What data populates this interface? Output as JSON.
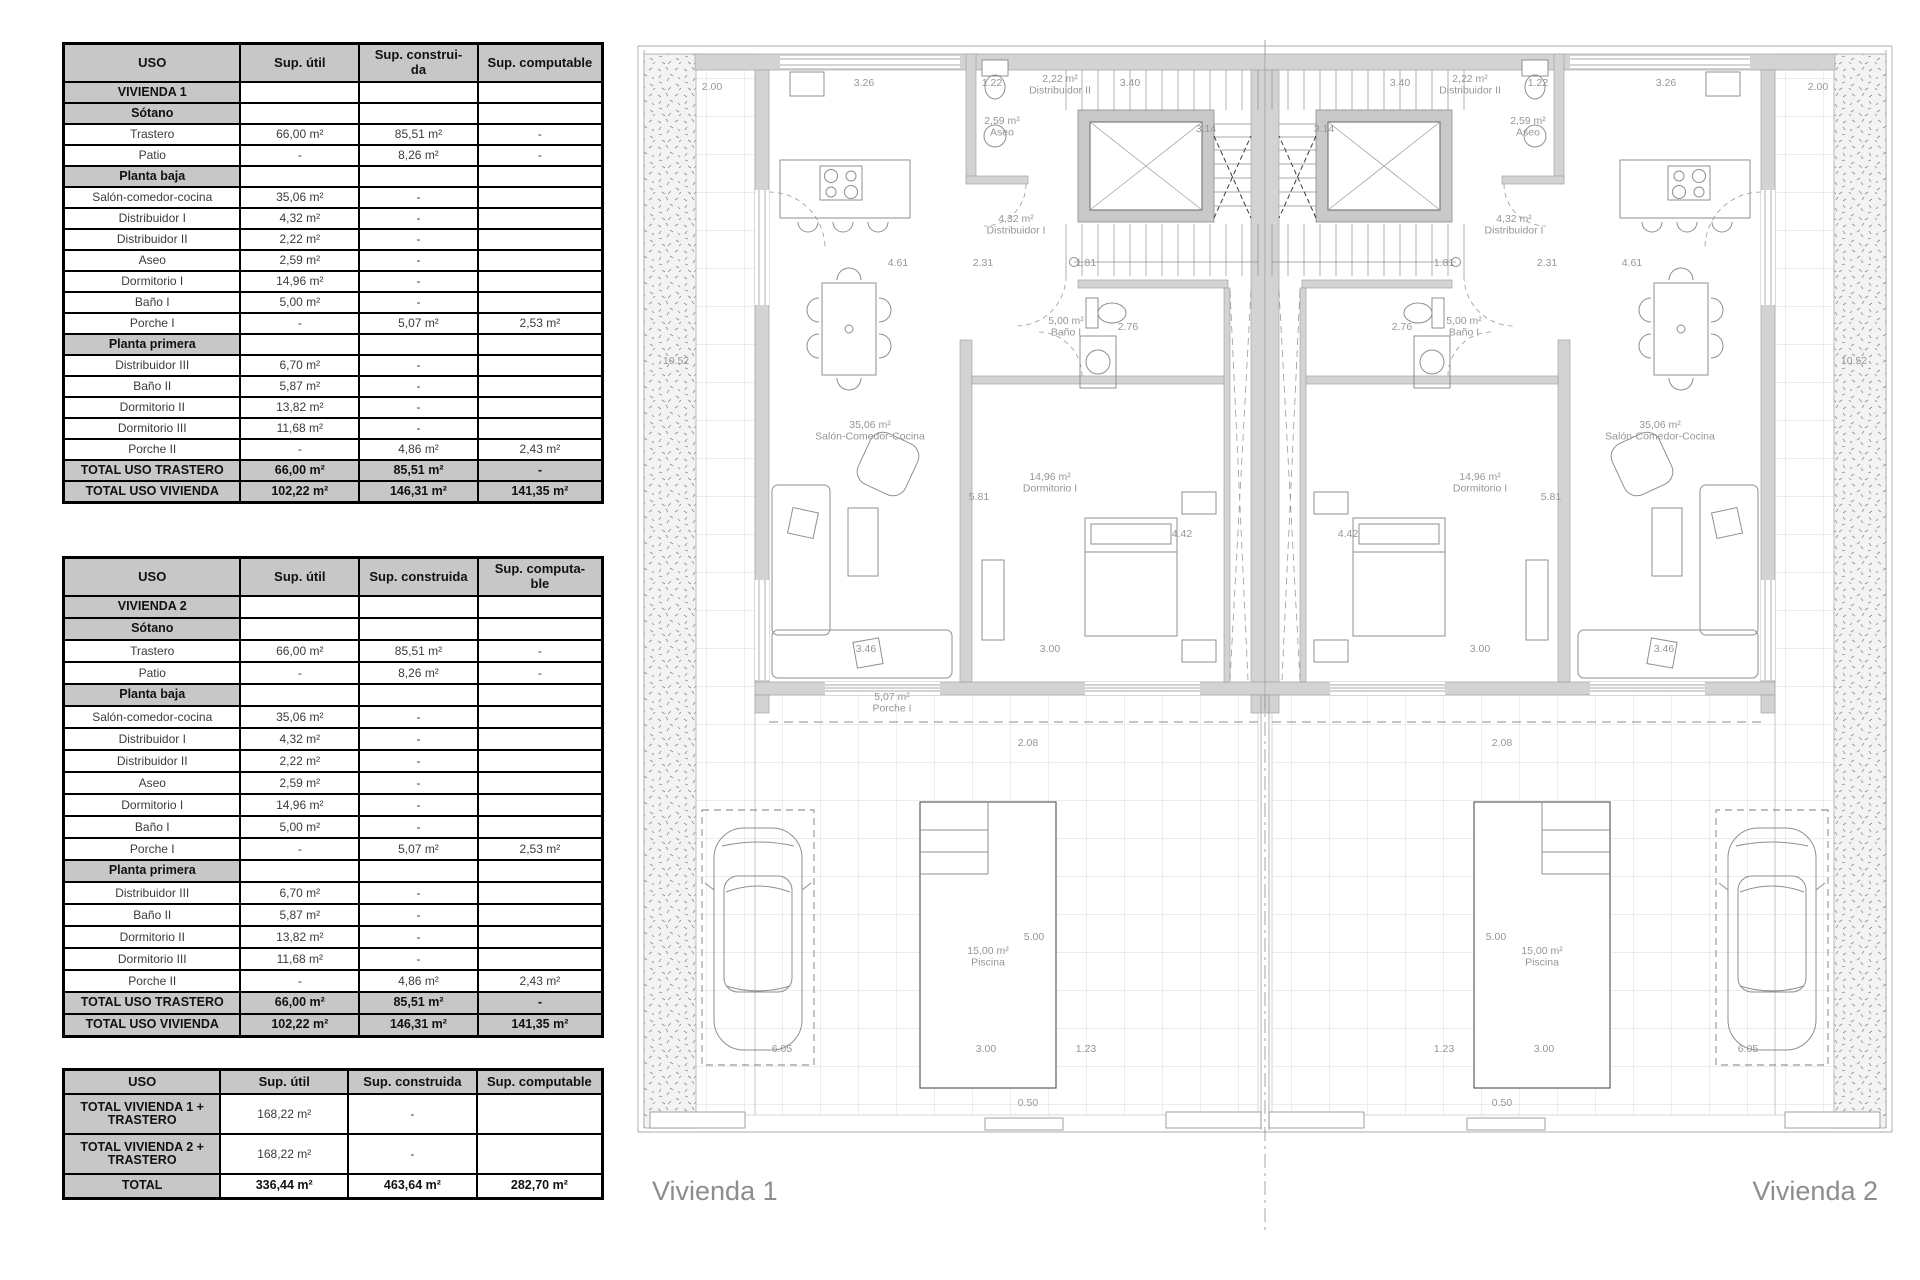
{
  "colors": {
    "table_header_bg": "#c7c7c7",
    "table_border": "#000000",
    "wall_fill": "#d3d3d3",
    "plan_label_gray": "#96969a",
    "unit_label_gray": "#8d8d8d"
  },
  "tables": [
    {
      "name": "vivienda-1-surfaces",
      "columns": [
        "USO",
        "Sup. útil",
        "Sup. construi-\nda",
        "Sup. computable"
      ],
      "rows": [
        {
          "type": "section",
          "cells": [
            "VIVIENDA 1",
            "",
            "",
            ""
          ]
        },
        {
          "type": "section",
          "cells": [
            "Sótano",
            "",
            "",
            ""
          ]
        },
        {
          "type": "data",
          "cells": [
            "Trastero",
            "66,00 m²",
            "85,51 m²",
            "-"
          ]
        },
        {
          "type": "data",
          "cells": [
            "Patio",
            "-",
            "8,26 m²",
            "-"
          ]
        },
        {
          "type": "section",
          "cells": [
            "Planta baja",
            "",
            "",
            ""
          ]
        },
        {
          "type": "data",
          "cells": [
            "Salón-comedor-cocina",
            "35,06 m²",
            "-",
            ""
          ]
        },
        {
          "type": "data",
          "cells": [
            "Distribuidor I",
            "4,32 m²",
            "-",
            ""
          ]
        },
        {
          "type": "data",
          "cells": [
            "Distribuidor II",
            "2,22 m²",
            "-",
            ""
          ]
        },
        {
          "type": "data",
          "cells": [
            "Aseo",
            "2,59 m²",
            "-",
            ""
          ]
        },
        {
          "type": "data",
          "cells": [
            "Dormitorio I",
            "14,96 m²",
            "-",
            ""
          ]
        },
        {
          "type": "data",
          "cells": [
            "Baño I",
            "5,00 m²",
            "-",
            ""
          ]
        },
        {
          "type": "data",
          "cells": [
            "Porche I",
            "-",
            "5,07 m²",
            "2,53 m²"
          ]
        },
        {
          "type": "section",
          "cells": [
            "Planta primera",
            "",
            "",
            ""
          ]
        },
        {
          "type": "data",
          "cells": [
            "Distribuidor III",
            "6,70 m²",
            "-",
            ""
          ]
        },
        {
          "type": "data",
          "cells": [
            "Baño II",
            "5,87 m²",
            "-",
            ""
          ]
        },
        {
          "type": "data",
          "cells": [
            "Dormitorio II",
            "13,82 m²",
            "-",
            ""
          ]
        },
        {
          "type": "data",
          "cells": [
            "Dormitorio III",
            "11,68 m²",
            "-",
            ""
          ]
        },
        {
          "type": "data",
          "cells": [
            "Porche II",
            "-",
            "4,86 m²",
            "2,43 m²"
          ]
        },
        {
          "type": "total",
          "cells": [
            "TOTAL USO TRASTERO",
            "66,00 m²",
            "85,51 m²",
            "-"
          ]
        },
        {
          "type": "total",
          "cells": [
            "TOTAL USO VIVIENDA",
            "102,22 m²",
            "146,31 m²",
            "141,35 m²"
          ]
        }
      ]
    },
    {
      "name": "vivienda-2-surfaces",
      "columns": [
        "USO",
        "Sup. útil",
        "Sup. construida",
        "Sup. computa-\nble"
      ],
      "rows": [
        {
          "type": "section",
          "cells": [
            "VIVIENDA 2",
            "",
            "",
            ""
          ]
        },
        {
          "type": "section",
          "cells": [
            "Sótano",
            "",
            "",
            ""
          ]
        },
        {
          "type": "data",
          "cells": [
            "Trastero",
            "66,00 m²",
            "85,51 m²",
            "-"
          ]
        },
        {
          "type": "data",
          "cells": [
            "Patio",
            "-",
            "8,26 m²",
            "-"
          ]
        },
        {
          "type": "section",
          "cells": [
            "Planta baja",
            "",
            "",
            ""
          ]
        },
        {
          "type": "data",
          "cells": [
            "Salón-comedor-cocina",
            "35,06 m²",
            "-",
            ""
          ]
        },
        {
          "type": "data",
          "cells": [
            "Distribuidor I",
            "4,32 m²",
            "-",
            ""
          ]
        },
        {
          "type": "data",
          "cells": [
            "Distribuidor II",
            "2,22 m²",
            "-",
            ""
          ]
        },
        {
          "type": "data",
          "cells": [
            "Aseo",
            "2,59 m²",
            "-",
            ""
          ]
        },
        {
          "type": "data",
          "cells": [
            "Dormitorio I",
            "14,96 m²",
            "-",
            ""
          ]
        },
        {
          "type": "data",
          "cells": [
            "Baño I",
            "5,00 m²",
            "-",
            ""
          ]
        },
        {
          "type": "data",
          "cells": [
            "Porche I",
            "-",
            "5,07 m²",
            "2,53 m²"
          ]
        },
        {
          "type": "section",
          "cells": [
            "Planta primera",
            "",
            "",
            ""
          ]
        },
        {
          "type": "data",
          "cells": [
            "Distribuidor III",
            "6,70 m²",
            "-",
            ""
          ]
        },
        {
          "type": "data",
          "cells": [
            "Baño II",
            "5,87 m²",
            "-",
            ""
          ]
        },
        {
          "type": "data",
          "cells": [
            "Dormitorio II",
            "13,82 m²",
            "-",
            ""
          ]
        },
        {
          "type": "data",
          "cells": [
            "Dormitorio III",
            "11,68 m²",
            "-",
            ""
          ]
        },
        {
          "type": "data",
          "cells": [
            "Porche II",
            "-",
            "4,86 m²",
            "2,43 m²"
          ]
        },
        {
          "type": "total",
          "cells": [
            "TOTAL USO TRASTERO",
            "66,00 m²",
            "85,51 m²",
            "-"
          ]
        },
        {
          "type": "total",
          "cells": [
            "TOTAL USO VIVIENDA",
            "102,22 m²",
            "146,31 m²",
            "141,35 m²"
          ]
        }
      ]
    },
    {
      "name": "grand-totals",
      "columns": [
        "USO",
        "Sup. útil",
        "Sup. construida",
        "Sup. computable"
      ],
      "rows": [
        {
          "type": "mixed",
          "cells": [
            "TOTAL VIVIENDA 1 +\nTRASTERO",
            "168,22 m²",
            "-",
            ""
          ]
        },
        {
          "type": "mixed",
          "cells": [
            "TOTAL VIVIENDA 2 +\nTRASTERO",
            "168,22 m²",
            "-",
            ""
          ]
        },
        {
          "type": "mixedbold",
          "cells": [
            "TOTAL",
            "336,44 m²",
            "463,64  m²",
            "282,70  m²"
          ]
        }
      ]
    }
  ],
  "plan": {
    "vivienda1_label": "Vivienda 1",
    "vivienda2_label": "Vivienda 2",
    "labels": [
      {
        "t": "2.00",
        "x": 82,
        "y": 50
      },
      {
        "t": "2.00",
        "x": 1188,
        "y": 50
      },
      {
        "t": "3.26",
        "x": 234,
        "y": 46
      },
      {
        "t": "3.26",
        "x": 1036,
        "y": 46
      },
      {
        "t": "1.22",
        "x": 362,
        "y": 46
      },
      {
        "t": "1.22",
        "x": 908,
        "y": 46
      },
      {
        "t": "2,22 m²",
        "l2": "Distribuidor II",
        "x": 430,
        "y": 42
      },
      {
        "t": "2,22 m²",
        "l2": "Distribuidor II",
        "x": 840,
        "y": 42
      },
      {
        "t": "3.40",
        "x": 500,
        "y": 46
      },
      {
        "t": "3.40",
        "x": 770,
        "y": 46
      },
      {
        "t": "2,59 m²",
        "l2": "Aseo",
        "x": 372,
        "y": 84
      },
      {
        "t": "2,59 m²",
        "l2": "Aseo",
        "x": 898,
        "y": 84
      },
      {
        "t": "3.14",
        "x": 576,
        "y": 92
      },
      {
        "t": "3.14",
        "x": 694,
        "y": 92
      },
      {
        "t": "4,32 m²",
        "l2": "Distribuidor I",
        "x": 386,
        "y": 182
      },
      {
        "t": "4,32 m²",
        "l2": "Distribuidor I",
        "x": 884,
        "y": 182
      },
      {
        "t": "4.61",
        "x": 268,
        "y": 226
      },
      {
        "t": "4.61",
        "x": 1002,
        "y": 226
      },
      {
        "t": "2.31",
        "x": 353,
        "y": 226
      },
      {
        "t": "2.31",
        "x": 917,
        "y": 226
      },
      {
        "t": "1.81",
        "x": 456,
        "y": 226
      },
      {
        "t": "1.81",
        "x": 814,
        "y": 226
      },
      {
        "t": "5,00 m²",
        "l2": "Baño I",
        "x": 436,
        "y": 284
      },
      {
        "t": "5,00 m²",
        "l2": "Baño I",
        "x": 834,
        "y": 284
      },
      {
        "t": "2.76",
        "x": 498,
        "y": 290
      },
      {
        "t": "2.76",
        "x": 772,
        "y": 290
      },
      {
        "t": "10.52",
        "x": 46,
        "y": 324
      },
      {
        "t": "10.52",
        "x": 1224,
        "y": 324
      },
      {
        "t": "35,06 m²",
        "l2": "Salón-Comedor-Cocina",
        "x": 240,
        "y": 388
      },
      {
        "t": "35,06 m²",
        "l2": "Salón-Comedor-Cocina",
        "x": 1030,
        "y": 388
      },
      {
        "t": "14,96 m²",
        "l2": "Dormitorio I",
        "x": 420,
        "y": 440
      },
      {
        "t": "14,96 m²",
        "l2": "Dormitorio I",
        "x": 850,
        "y": 440
      },
      {
        "t": "5.81",
        "x": 349,
        "y": 460
      },
      {
        "t": "5.81",
        "x": 921,
        "y": 460
      },
      {
        "t": "4.42",
        "x": 552,
        "y": 497
      },
      {
        "t": "4.42",
        "x": 718,
        "y": 497
      },
      {
        "t": "3.46",
        "x": 236,
        "y": 612
      },
      {
        "t": "3.46",
        "x": 1034,
        "y": 612
      },
      {
        "t": "3.00",
        "x": 420,
        "y": 612
      },
      {
        "t": "3.00",
        "x": 850,
        "y": 612
      },
      {
        "t": "5,07 m²",
        "l2": "Porche I",
        "x": 262,
        "y": 660
      },
      {
        "t": "2.08",
        "x": 398,
        "y": 706
      },
      {
        "t": "2.08",
        "x": 872,
        "y": 706
      },
      {
        "t": "15,00 m²",
        "l2": "Piscina",
        "x": 358,
        "y": 914
      },
      {
        "t": "15,00 m²",
        "l2": "Piscina",
        "x": 912,
        "y": 914
      },
      {
        "t": "5.00",
        "x": 404,
        "y": 900
      },
      {
        "t": "5.00",
        "x": 866,
        "y": 900
      },
      {
        "t": "3.00",
        "x": 356,
        "y": 1012
      },
      {
        "t": "3.00",
        "x": 914,
        "y": 1012
      },
      {
        "t": "1.23",
        "x": 456,
        "y": 1012
      },
      {
        "t": "1.23",
        "x": 814,
        "y": 1012
      },
      {
        "t": "6.05",
        "x": 152,
        "y": 1012
      },
      {
        "t": "6.05",
        "x": 1118,
        "y": 1012
      },
      {
        "t": "0.50",
        "x": 398,
        "y": 1066
      },
      {
        "t": "0.50",
        "x": 872,
        "y": 1066
      }
    ]
  }
}
